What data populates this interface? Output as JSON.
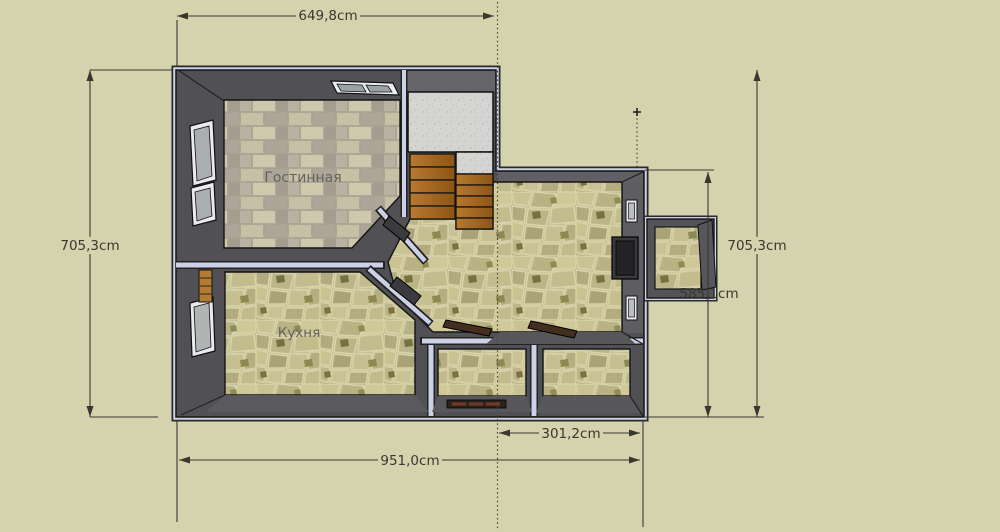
{
  "scene": {
    "title": "3d-floor-plan-top-view",
    "background": "#d5d3ae",
    "wall_color": "#515155",
    "wall_face_color": "#5a5a5e",
    "outline_color": "#cdd1e8",
    "edge_color": "#161616",
    "dimension_color": "#38382e",
    "wood_color": "#a96c28",
    "concrete_color": "#d4d4d2",
    "brick_light": "#c8c0a5",
    "brick_dark": "#a8a295",
    "stone_base": "#c5be8e",
    "stone_dark_accent": "#75723f"
  },
  "rooms": {
    "living_room": {
      "label": "Гостинная"
    },
    "kitchen": {
      "label": "Кухня"
    }
  },
  "dimensions": {
    "top": "649,8cm",
    "left": "705,3cm",
    "right": "705,3cm",
    "wing_height": "585,1cm",
    "wing_width": "301,2cm",
    "bottom": "951,0cm"
  }
}
